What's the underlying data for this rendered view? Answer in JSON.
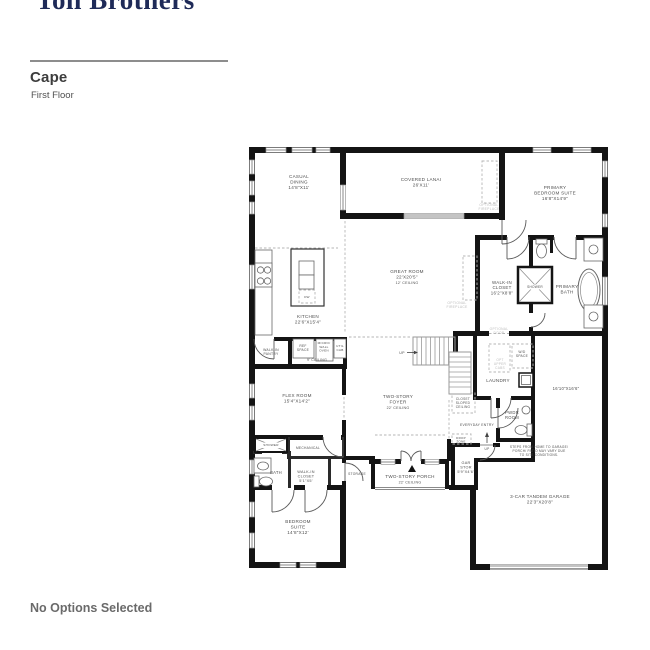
{
  "header": {
    "logo": "Toll Brothers",
    "plan_name": "Cape",
    "floor_name": "First Floor"
  },
  "footer": {
    "options_text": "No Options Selected"
  },
  "floorplan": {
    "label_color": "#4e4e4e",
    "optional_color": "#bdbdbd",
    "wall_color": "#141414",
    "labels": [
      {
        "id": "casual-dining",
        "x": 299,
        "y": 178,
        "size": 4.6,
        "lh": 5.4,
        "lines": [
          "CASUAL",
          "DINING",
          "14'8\"X11'"
        ]
      },
      {
        "id": "covered-lanai",
        "x": 421,
        "y": 181,
        "size": 4.6,
        "lh": 5.4,
        "lines": [
          "COVERED LANAI",
          "26'X11'"
        ]
      },
      {
        "id": "primary-bedroom-suite",
        "x": 555,
        "y": 189,
        "size": 4.6,
        "lh": 5.4,
        "lines": [
          "PRIMARY",
          "BEDROOM SUITE",
          "16'8\"X14'9\""
        ]
      },
      {
        "id": "great-room",
        "x": 407,
        "y": 273,
        "size": 4.6,
        "lh": 5.4,
        "lines": [
          "GREAT ROOM",
          "22'X20'5\"",
          {
            "t": "12' CEILING",
            "s": 3.6
          }
        ]
      },
      {
        "id": "kitchen",
        "x": 308,
        "y": 318,
        "size": 4.6,
        "lh": 5.4,
        "lines": [
          "KITCHEN",
          "22'6\"X15'4\""
        ]
      },
      {
        "id": "optional-fireplace-lanai",
        "x": 489,
        "y": 206,
        "size": 3.4,
        "lh": 4,
        "color": "#bdbdbd",
        "lines": [
          "OPTIONAL",
          "FIREPLACE"
        ]
      },
      {
        "id": "optional-fireplace-great-room",
        "x": 457,
        "y": 304,
        "size": 3.4,
        "lh": 4,
        "color": "#bdbdbd",
        "lines": [
          "OPTIONAL",
          "FIREPLACE"
        ]
      },
      {
        "id": "walk-in-closet-primary",
        "x": 502,
        "y": 284,
        "size": 4.4,
        "lh": 5.2,
        "lines": [
          "WALK-IN",
          "CLOSET",
          "16'2\"X8'8\""
        ]
      },
      {
        "id": "shower-primary",
        "x": 535,
        "y": 288,
        "size": 3.2,
        "lh": 4,
        "lines": [
          "SHOWER"
        ]
      },
      {
        "id": "primary-bath",
        "x": 567,
        "y": 288,
        "size": 4.6,
        "lh": 5.4,
        "lines": [
          "PRIMARY",
          "BATH"
        ]
      },
      {
        "id": "walk-in-pantry",
        "x": 271,
        "y": 351,
        "size": 3.4,
        "lh": 4.2,
        "lines": [
          "WALK-IN",
          "PANTRY"
        ]
      },
      {
        "id": "ref-space",
        "x": 303,
        "y": 347,
        "size": 3.3,
        "lh": 4,
        "lines": [
          "REF",
          "SPACE"
        ]
      },
      {
        "id": "micro-wall-oven",
        "x": 324,
        "y": 344,
        "size": 3.1,
        "lh": 3.8,
        "lines": [
          "MICRO/",
          "WALL",
          "OVEN"
        ]
      },
      {
        "id": "util-cab",
        "x": 340,
        "y": 347,
        "size": 3.1,
        "lh": 3.8,
        "lines": [
          "UTIL",
          "CAB"
        ]
      },
      {
        "id": "nine-ft-ceiling",
        "x": 317,
        "y": 361,
        "size": 3.5,
        "lh": 4,
        "lines": [
          "9' CEILING"
        ]
      },
      {
        "id": "optional-door",
        "x": 499,
        "y": 330,
        "size": 3.3,
        "lh": 4,
        "color": "#bdbdbd",
        "lines": [
          "OPTIONAL",
          "DOOR"
        ]
      },
      {
        "id": "wd-space",
        "x": 522,
        "y": 353,
        "size": 3.3,
        "lh": 4,
        "lines": [
          "W/D",
          "SPACE"
        ]
      },
      {
        "id": "opt-upper-cabs",
        "x": 500,
        "y": 361,
        "size": 3.2,
        "lh": 3.9,
        "color": "#bdbdbd",
        "lines": [
          "OPT",
          "UPPER",
          "CABS"
        ]
      },
      {
        "id": "laundry",
        "x": 498,
        "y": 382,
        "size": 4.6,
        "lh": 5.4,
        "lines": [
          "LAUNDRY"
        ]
      },
      {
        "id": "room-16-10",
        "x": 566,
        "y": 390,
        "size": 4.2,
        "lh": 5,
        "lines": [
          "16'10\"X16'6\""
        ]
      },
      {
        "id": "flex-room",
        "x": 297,
        "y": 397,
        "size": 4.6,
        "lh": 5.4,
        "lines": [
          "FLEX ROOM",
          "15'4\"X14'2\""
        ]
      },
      {
        "id": "two-story-foyer",
        "x": 398,
        "y": 398,
        "size": 4.6,
        "lh": 5.4,
        "lines": [
          "TWO-STORY",
          "FOYER",
          {
            "t": "22' CEILING",
            "s": 3.6
          }
        ]
      },
      {
        "id": "closet-sloped-ceiling",
        "x": 463,
        "y": 400,
        "size": 3.2,
        "lh": 3.9,
        "lines": [
          "CLOSET",
          "SLOPED",
          "CEILING"
        ]
      },
      {
        "id": "up-stairs",
        "x": 402,
        "y": 354,
        "size": 3.6,
        "lh": 4,
        "lines": [
          "UP"
        ]
      },
      {
        "id": "everyday-entry",
        "x": 477,
        "y": 426,
        "size": 3.4,
        "lh": 4,
        "lines": [
          "EVERYDAY ENTRY"
        ]
      },
      {
        "id": "pwdr-room",
        "x": 512,
        "y": 414,
        "size": 4.2,
        "lh": 5,
        "lines": [
          "PWDR",
          "ROOM"
        ]
      },
      {
        "id": "drop-zone",
        "x": 461,
        "y": 439,
        "size": 3,
        "lh": 3.6,
        "lines": [
          "DROP",
          "ZONE"
        ]
      },
      {
        "id": "up-garage",
        "x": 487,
        "y": 450,
        "size": 3.2,
        "lh": 3.8,
        "lines": [
          "UP"
        ]
      },
      {
        "id": "steps-note",
        "x": 539,
        "y": 448,
        "size": 3.2,
        "lh": 4,
        "lines": [
          "STEPS FROM HOME TO GARAGE/",
          "PORCH/ PATIO MAY VARY DUE",
          "TO SITE CONDITIONS."
        ]
      },
      {
        "id": "gar-stor",
        "x": 466,
        "y": 464,
        "size": 3.8,
        "lh": 4.6,
        "lines": [
          "GAR",
          "STOR",
          "5'9\"X4'6\""
        ]
      },
      {
        "id": "shower-bedroom",
        "x": 271,
        "y": 446,
        "size": 3.1,
        "lh": 3.8,
        "lines": [
          "SHOWER"
        ]
      },
      {
        "id": "mechanical",
        "x": 308,
        "y": 449,
        "size": 3.3,
        "lh": 4,
        "lines": [
          "MECHANICAL"
        ]
      },
      {
        "id": "bath",
        "x": 276,
        "y": 474,
        "size": 4.2,
        "lh": 5,
        "lines": [
          "BATH"
        ]
      },
      {
        "id": "walk-in-closet-bedroom",
        "x": 306,
        "y": 473,
        "size": 3.8,
        "lh": 4.6,
        "lines": [
          "WALK-IN",
          "CLOSET",
          "5'1\"X5'"
        ]
      },
      {
        "id": "storage",
        "x": 357,
        "y": 475,
        "size": 3.3,
        "lh": 4,
        "lines": [
          "STORAGE"
        ]
      },
      {
        "id": "two-story-porch",
        "x": 410,
        "y": 478,
        "size": 4.6,
        "lh": 5.4,
        "lines": [
          "TWO-STORY PORCH",
          {
            "t": "22' CEILING",
            "s": 3.6
          }
        ]
      },
      {
        "id": "garage",
        "x": 540,
        "y": 498,
        "size": 4.6,
        "lh": 5.4,
        "lines": [
          "3-CAR TANDEM GARAGE",
          "22'3\"X20'8\""
        ]
      },
      {
        "id": "bedroom-suite",
        "x": 298,
        "y": 523,
        "size": 4.6,
        "lh": 5.4,
        "lines": [
          "BEDROOM",
          "SUITE",
          "14'8\"X12'"
        ]
      },
      {
        "id": "dishwasher",
        "x": 307,
        "y": 298,
        "size": 3,
        "lh": 3.6,
        "lines": [
          "DW"
        ]
      }
    ]
  }
}
